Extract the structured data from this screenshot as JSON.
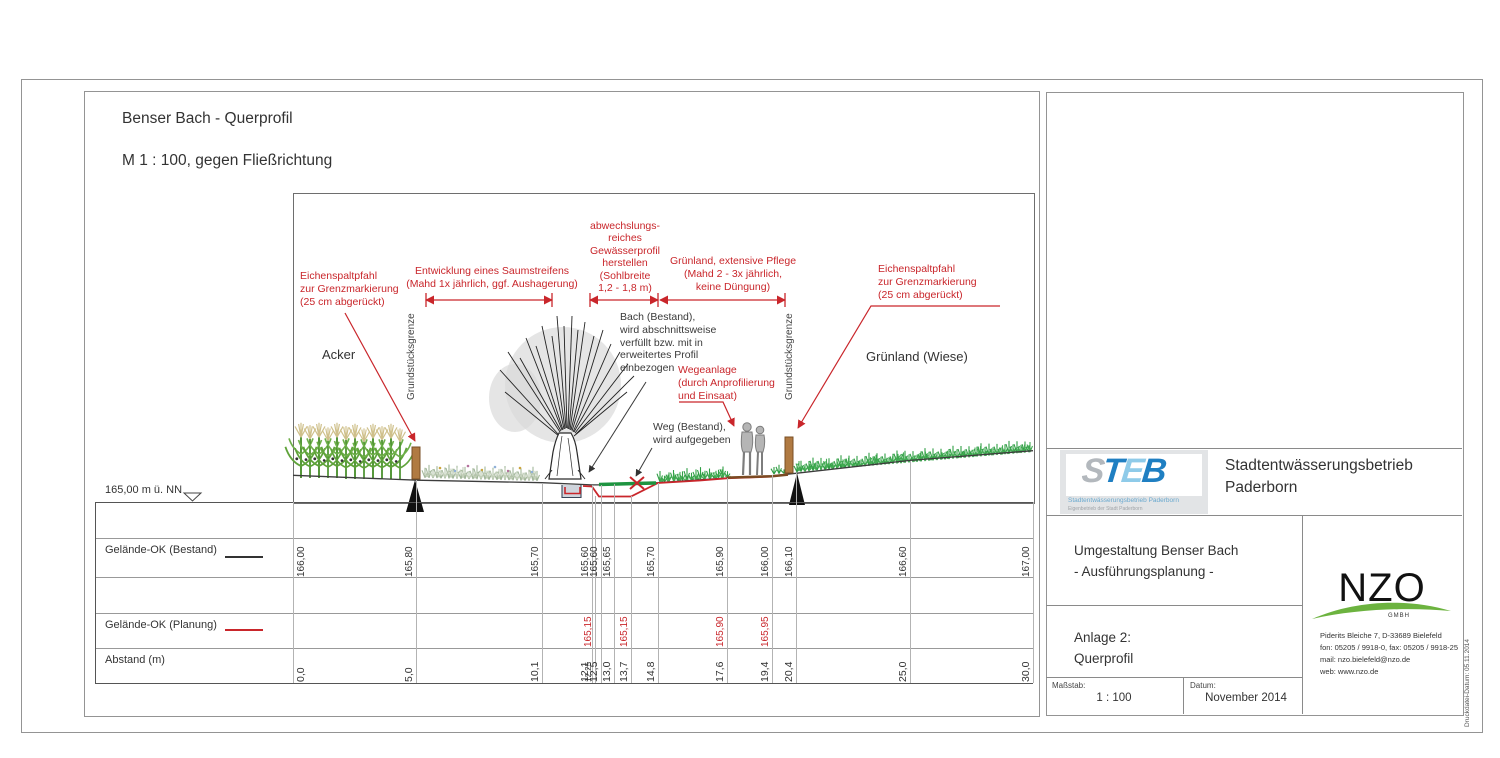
{
  "sheet": {
    "title": "Benser Bach - Querprofil",
    "subtitle": "M 1 : 100, gegen Fließrichtung"
  },
  "drawing": {
    "datum_label": "165,00 m ü. NN",
    "label_acker": "Acker",
    "label_gruenland": "Grünland (Wiese)",
    "boundary_left": "Grundstücksgrenze",
    "boundary_right": "Grundstücksgrenze",
    "ann_post_left": "Eichenspaltpfahl\nzur Grenzmarkierung\n(25 cm abgerückt)",
    "ann_saumstreifen": "Entwicklung eines Saumstreifens\n(Mahd 1x jährlich, ggf. Aushagerung)",
    "ann_gewaesserprofil": "abwechslungs-\nreiches\nGewässerprofil\nherstellen\n(Sohlbreite\n1,2 - 1,8 m)",
    "ann_gruenland": "Grünland, extensive Pflege\n(Mahd 2 - 3x jährlich,\nkeine Düngung)",
    "ann_post_right": "Eichenspaltpfahl\nzur Grenzmarkierung\n(25 cm abgerückt)",
    "ann_bach": "Bach (Bestand),\nwird abschnittsweise\nverfüllt bzw. mit in\nerweitertes Profil\neinbezogen",
    "ann_weg_bestand": "Weg (Bestand),\nwird aufgegeben",
    "ann_wegeanlage": "Wegeanlage\n(durch Anprofilierung\nund Einsaat)"
  },
  "profile_table": {
    "label_bestand": "Gelände-OK (Bestand)",
    "label_planung": "Gelände-OK (Planung)",
    "label_abstand": "Abstand (m)",
    "columns": [
      {
        "abstand": "0,0",
        "bestand": "166,00",
        "planung": ""
      },
      {
        "abstand": "5,0",
        "bestand": "165,80",
        "planung": ""
      },
      {
        "abstand": "10,1",
        "bestand": "165,70",
        "planung": ""
      },
      {
        "abstand": "12,1",
        "bestand": "165,60",
        "planung": ""
      },
      {
        "abstand": "12,25",
        "bestand": "",
        "planung": "165,15"
      },
      {
        "abstand": "12,5",
        "bestand": "165,60",
        "planung": ""
      },
      {
        "abstand": "13,0",
        "bestand": "165,65",
        "planung": ""
      },
      {
        "abstand": "13,7",
        "bestand": "",
        "planung": "165,15"
      },
      {
        "abstand": "14,8",
        "bestand": "165,70",
        "planung": ""
      },
      {
        "abstand": "17,6",
        "bestand": "165,90",
        "planung": "165,90"
      },
      {
        "abstand": "19,4",
        "bestand": "166,00",
        "planung": "165,95"
      },
      {
        "abstand": "20,4",
        "bestand": "166,10",
        "planung": ""
      },
      {
        "abstand": "25,0",
        "bestand": "166,60",
        "planung": ""
      },
      {
        "abstand": "30,0",
        "bestand": "167,00",
        "planung": ""
      }
    ]
  },
  "titleblock": {
    "steb_letters": [
      "S",
      "T",
      "E",
      "B"
    ],
    "steb_sub1": "Stadtentwässerungsbetrieb Paderborn",
    "steb_sub2": "Eigenbetrieb der Stadt Paderborn",
    "company": "Stadtentwässerungsbetrieb\nPaderborn",
    "project": "Umgestaltung Benser Bach\n- Ausführungsplanung -",
    "attachment": "Anlage 2:\nQuerprofil",
    "scale_label": "Maßstab:",
    "scale_value": "1 : 100",
    "date_label": "Datum:",
    "date_value": "November 2014",
    "nzo_name": "NZO",
    "nzo_sub": "GMBH",
    "nzo_address": "Piderits Bleiche 7, D-33689 Bielefeld\nfon: 05205 / 9918-0, fax: 05205 / 9918-25\nmail: nzo.bielefeld@nzo.de\nweb: www.nzo.de",
    "print_note": "Druckdatei-Datum: 05.11.2014"
  },
  "colors": {
    "annotation_red": "#c9262b",
    "vegetation_green": "#2f9e44",
    "post_brown": "#b07a42",
    "steb_blue": "#1f7fc2",
    "steb_lightblue": "#8fcbe9",
    "nzo_green": "#6cb33f"
  }
}
